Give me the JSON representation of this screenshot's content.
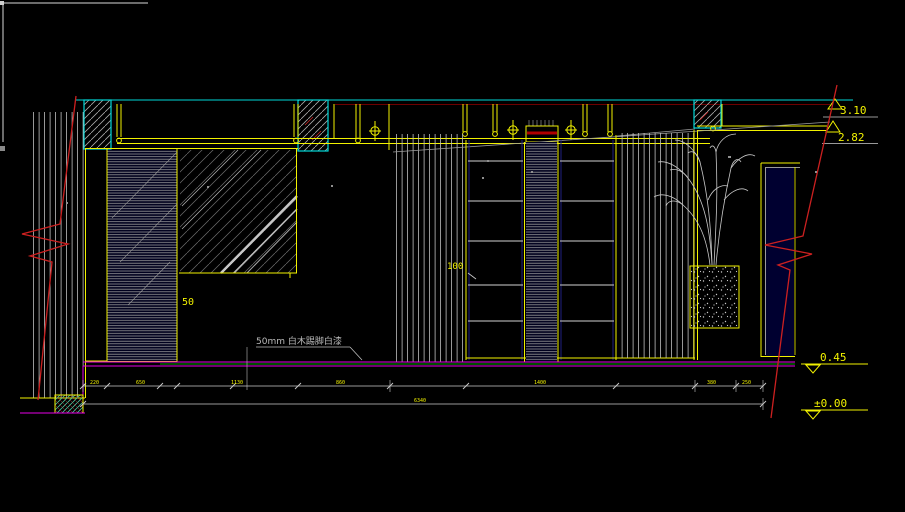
{
  "drawing": {
    "title": "interior-elevation-cad-view",
    "levels": {
      "ceiling_top": "3.10",
      "soffit": "2.82",
      "sill": "0.45",
      "floor": "±0.00"
    },
    "labels": {
      "panel_gap": "50",
      "shelf_depth": "100",
      "material_note": "50mm 白木踢脚白漆"
    },
    "dimensions": {
      "row1": [
        "220",
        "650",
        "1130",
        "860",
        "1400",
        "380",
        "250"
      ],
      "total": "6340"
    },
    "colors": {
      "background": "#000000",
      "cad_yellow": "#f2f200",
      "cad_cyan": "#00d9d9",
      "cad_magenta": "#e800e8",
      "cad_green": "#00a000",
      "cad_red": "#cc2020",
      "cad_dark_red": "#6e0000",
      "cad_gray": "#a8a8a8"
    }
  }
}
